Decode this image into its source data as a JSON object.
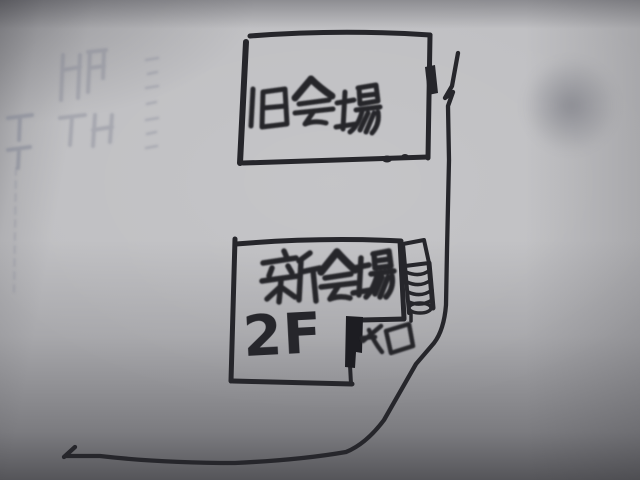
{
  "photo": {
    "description": "hand-drawn marker sketch map on gray paper",
    "paper_color": "#bfbfc2",
    "ink_color": "#26262b"
  },
  "map": {
    "old_venue": {
      "label": "旧会場"
    },
    "new_venue": {
      "label": "新会場",
      "floor": "2F",
      "entrance": "入口"
    }
  }
}
